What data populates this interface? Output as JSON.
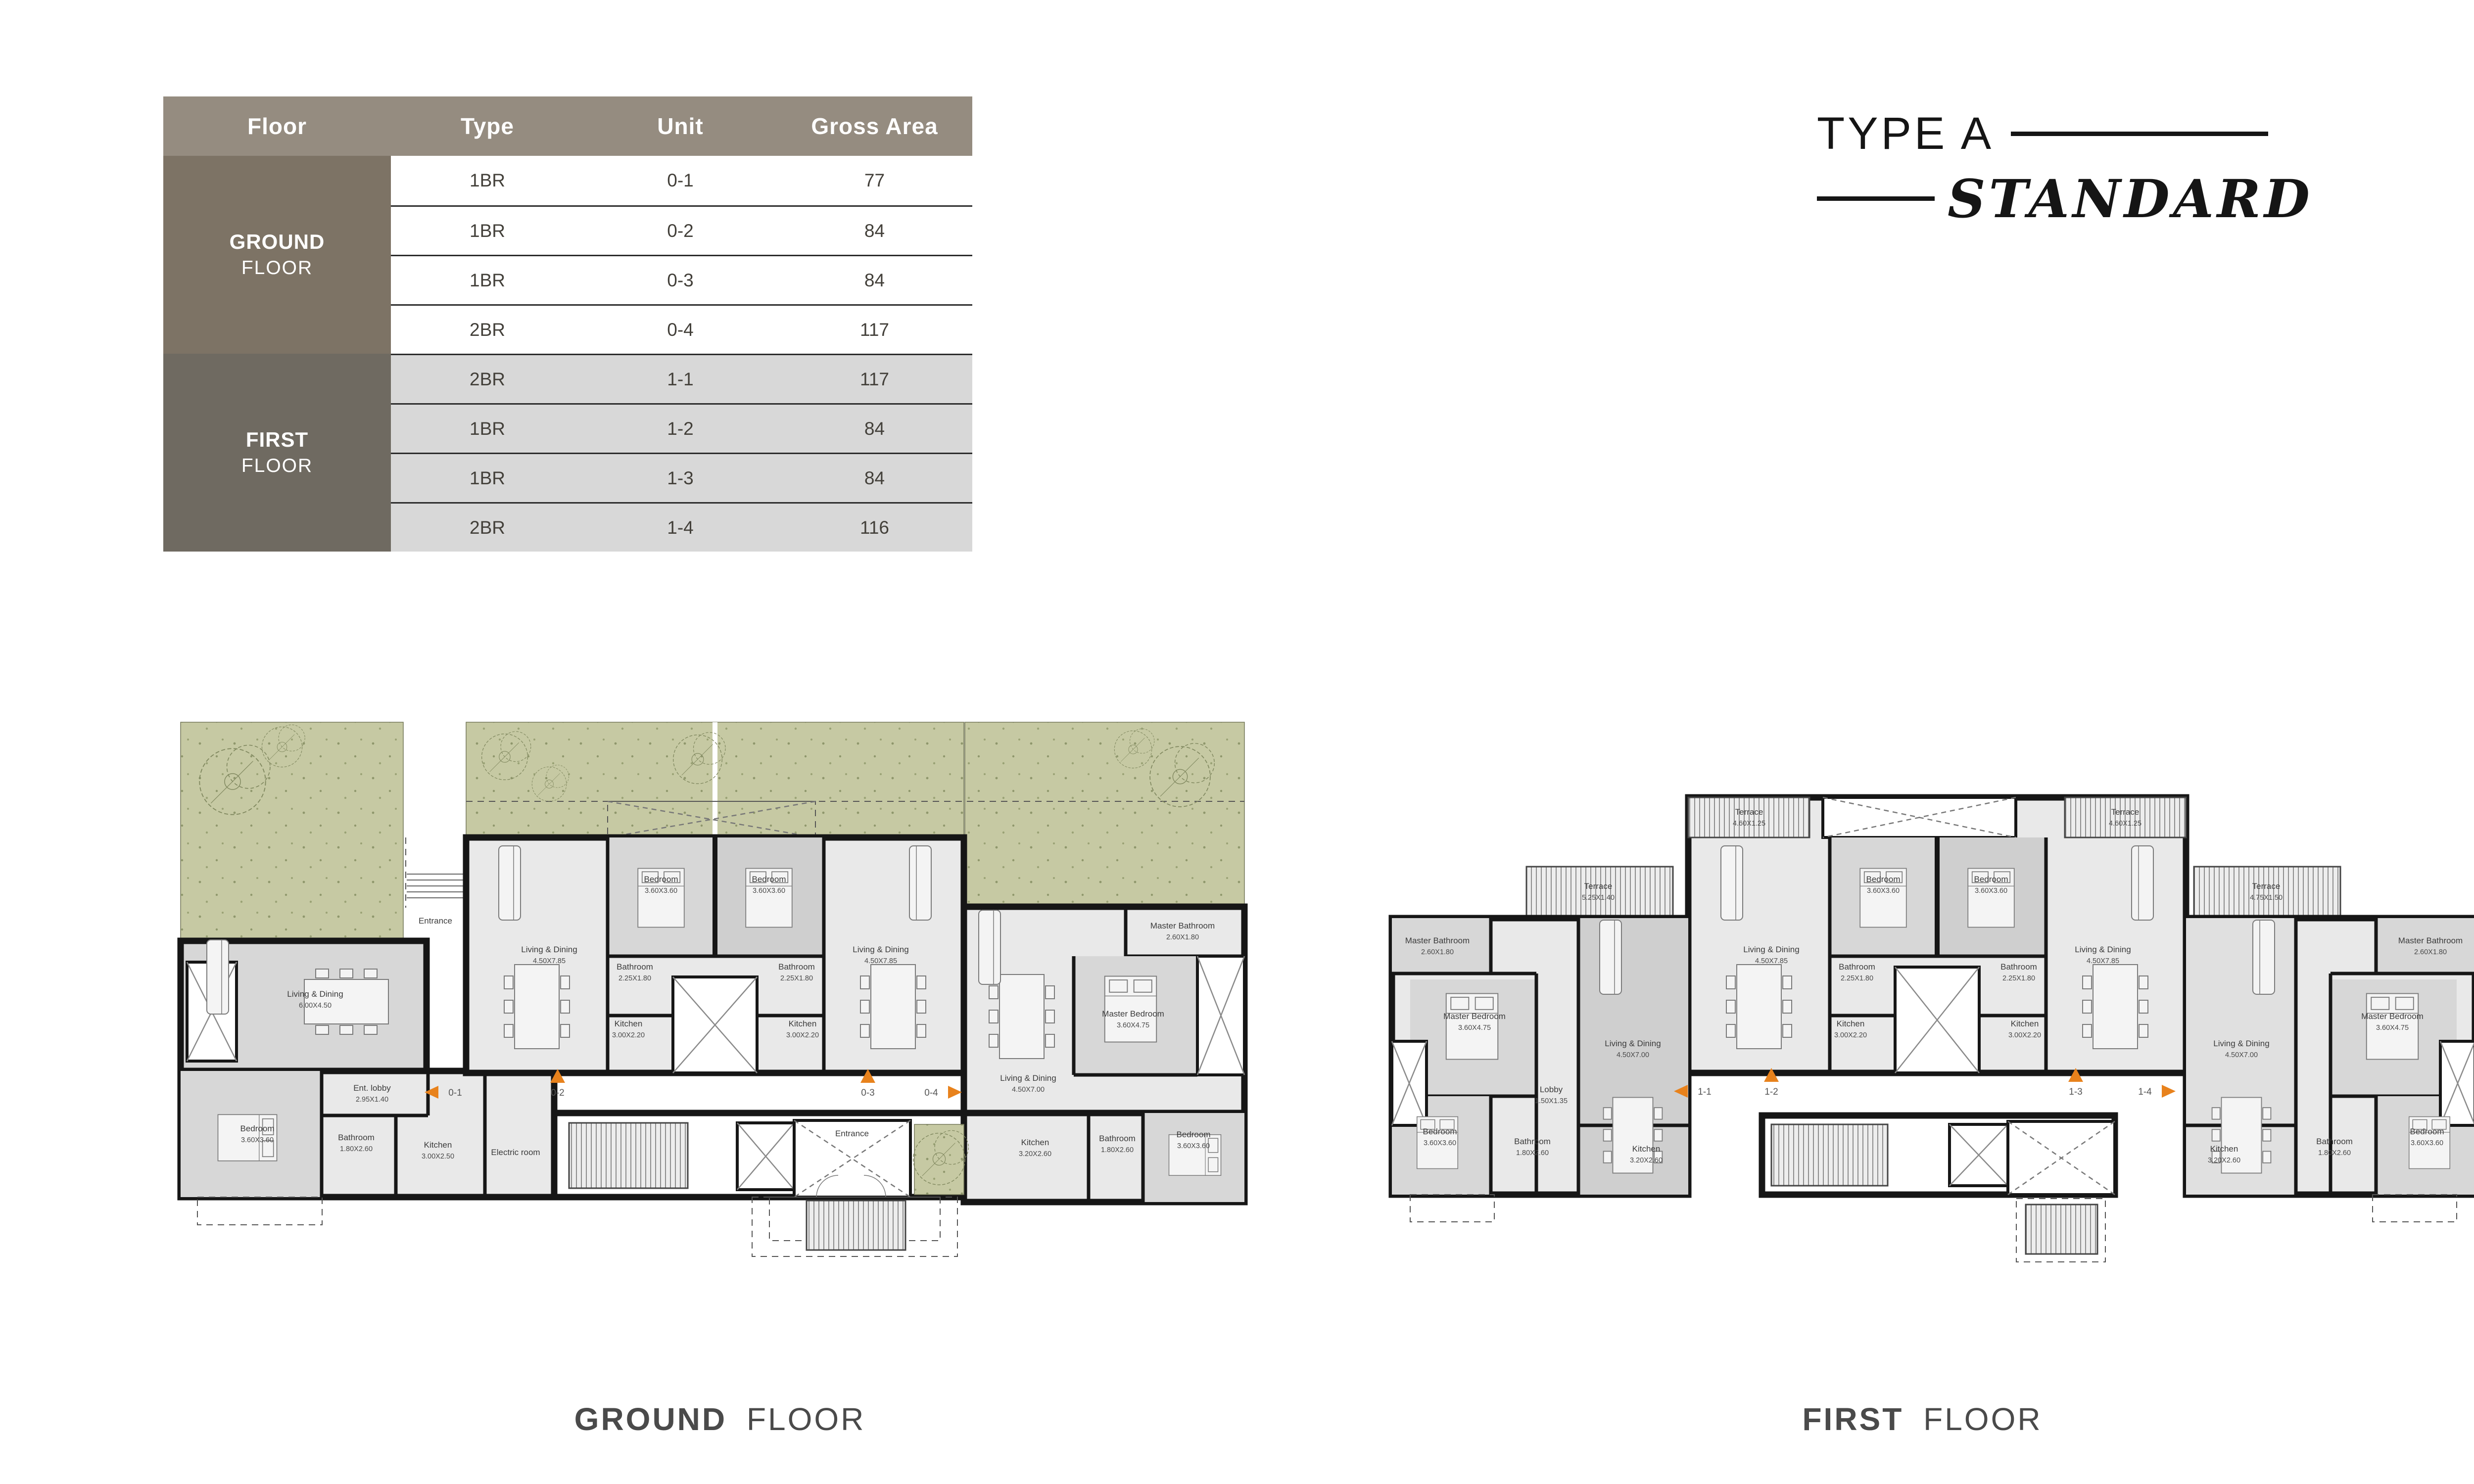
{
  "title": {
    "line1": "TYPE A",
    "line2": "STANDARD"
  },
  "table": {
    "headers": [
      "Floor",
      "Type",
      "Unit",
      "Gross Area"
    ],
    "floor_groups": [
      {
        "bold": "GROUND",
        "light": "FLOOR"
      },
      {
        "bold": "FIRST",
        "light": "FLOOR"
      }
    ],
    "rows": [
      {
        "type": "1BR",
        "unit": "0-1",
        "area": "77"
      },
      {
        "type": "1BR",
        "unit": "0-2",
        "area": "84"
      },
      {
        "type": "1BR",
        "unit": "0-3",
        "area": "84"
      },
      {
        "type": "2BR",
        "unit": "0-4",
        "area": "117"
      },
      {
        "type": "2BR",
        "unit": "1-1",
        "area": "117"
      },
      {
        "type": "1BR",
        "unit": "1-2",
        "area": "84"
      },
      {
        "type": "1BR",
        "unit": "1-3",
        "area": "84"
      },
      {
        "type": "2BR",
        "unit": "1-4",
        "area": "116"
      }
    ]
  },
  "plans": [
    {
      "id": "ground",
      "caption": {
        "bold": "GROUND",
        "light": "FLOOR"
      },
      "markers": [
        {
          "id": "0-1",
          "dir": "left"
        },
        {
          "id": "0-2",
          "dir": "up"
        },
        {
          "id": "0-3",
          "dir": "up"
        },
        {
          "id": "0-4",
          "dir": "right"
        }
      ],
      "labels": [
        {
          "name": "Entrance",
          "dims": ""
        },
        {
          "name": "Living & Dining",
          "dims": "6.00X4.50"
        },
        {
          "name": "Ent. lobby",
          "dims": "2.95X1.40"
        },
        {
          "name": "Bedroom",
          "dims": "3.60X3.60"
        },
        {
          "name": "Bathroom",
          "dims": "1.80X2.60"
        },
        {
          "name": "Kitchen",
          "dims": "3.00X2.50"
        },
        {
          "name": "Electric room",
          "dims": ""
        },
        {
          "name": "Living & Dining",
          "dims": "4.50X7.85"
        },
        {
          "name": "Bedroom",
          "dims": "3.60X3.60"
        },
        {
          "name": "Bathroom",
          "dims": "2.25X1.80"
        },
        {
          "name": "Kitchen",
          "dims": "3.00X2.20"
        },
        {
          "name": "Bedroom",
          "dims": "3.60X3.60"
        },
        {
          "name": "Bathroom",
          "dims": "2.25X1.80"
        },
        {
          "name": "Kitchen",
          "dims": "3.00X2.20"
        },
        {
          "name": "Living & Dining",
          "dims": "4.50X7.85"
        },
        {
          "name": "Living & Dining",
          "dims": "4.50X7.00"
        },
        {
          "name": "Master Bedroom",
          "dims": "3.60X4.75"
        },
        {
          "name": "Master Bathroom",
          "dims": "2.60X1.80"
        },
        {
          "name": "Bedroom",
          "dims": "3.60X3.60"
        },
        {
          "name": "Bathroom",
          "dims": "1.80X2.60"
        },
        {
          "name": "Kitchen",
          "dims": "3.20X2.60"
        },
        {
          "name": "Entrance",
          "dims": ""
        }
      ]
    },
    {
      "id": "first",
      "caption": {
        "bold": "FIRST",
        "light": "FLOOR"
      },
      "markers": [
        {
          "id": "1-1",
          "dir": "left"
        },
        {
          "id": "1-2",
          "dir": "up"
        },
        {
          "id": "1-3",
          "dir": "up"
        },
        {
          "id": "1-4",
          "dir": "right"
        }
      ],
      "labels": [
        {
          "name": "Terrace",
          "dims": "5.25X1.40"
        },
        {
          "name": "Master Bathroom",
          "dims": "2.60X1.80"
        },
        {
          "name": "Master Bedroom",
          "dims": "3.60X4.75"
        },
        {
          "name": "Living & Dining",
          "dims": "4.50X7.00"
        },
        {
          "name": "Lobby",
          "dims": "1.50X1.35"
        },
        {
          "name": "Bedroom",
          "dims": "3.60X3.60"
        },
        {
          "name": "Bathroom",
          "dims": "1.80X2.60"
        },
        {
          "name": "Kitchen",
          "dims": "3.20X2.60"
        },
        {
          "name": "Terrace",
          "dims": "4.60X1.25"
        },
        {
          "name": "Bedroom",
          "dims": "3.60X3.60"
        },
        {
          "name": "Bathroom",
          "dims": "2.25X1.80"
        },
        {
          "name": "Kitchen",
          "dims": "3.00X2.20"
        },
        {
          "name": "Living & Dining",
          "dims": "4.50X7.85"
        },
        {
          "name": "Terrace",
          "dims": "4.60X1.25"
        },
        {
          "name": "Bedroom",
          "dims": "3.60X3.60"
        },
        {
          "name": "Bathroom",
          "dims": "2.25X1.80"
        },
        {
          "name": "Kitchen",
          "dims": "3.00X2.20"
        },
        {
          "name": "Living & Dining",
          "dims": "4.50X7.85"
        },
        {
          "name": "Terrace",
          "dims": "4.75X1.50"
        },
        {
          "name": "Master Bathroom",
          "dims": "2.60X1.80"
        },
        {
          "name": "Master Bedroom",
          "dims": "3.60X4.75"
        },
        {
          "name": "Living & Dining",
          "dims": "4.50X7.00"
        },
        {
          "name": "Bedroom",
          "dims": "3.60X3.60"
        },
        {
          "name": "Bathroom",
          "dims": "1.80X2.60"
        },
        {
          "name": "Kitchen",
          "dims": "3.20X2.60"
        }
      ]
    }
  ],
  "colors": {
    "accent_orange": "#E8821C",
    "garden_green": "#C6C9A3",
    "table_header_bg": "#958C80",
    "ground_cell_bg": "#7D7365",
    "first_cell_bg": "#6F6A61",
    "alt_row_bg": "#D8D8D8",
    "wall_black": "#161616"
  }
}
